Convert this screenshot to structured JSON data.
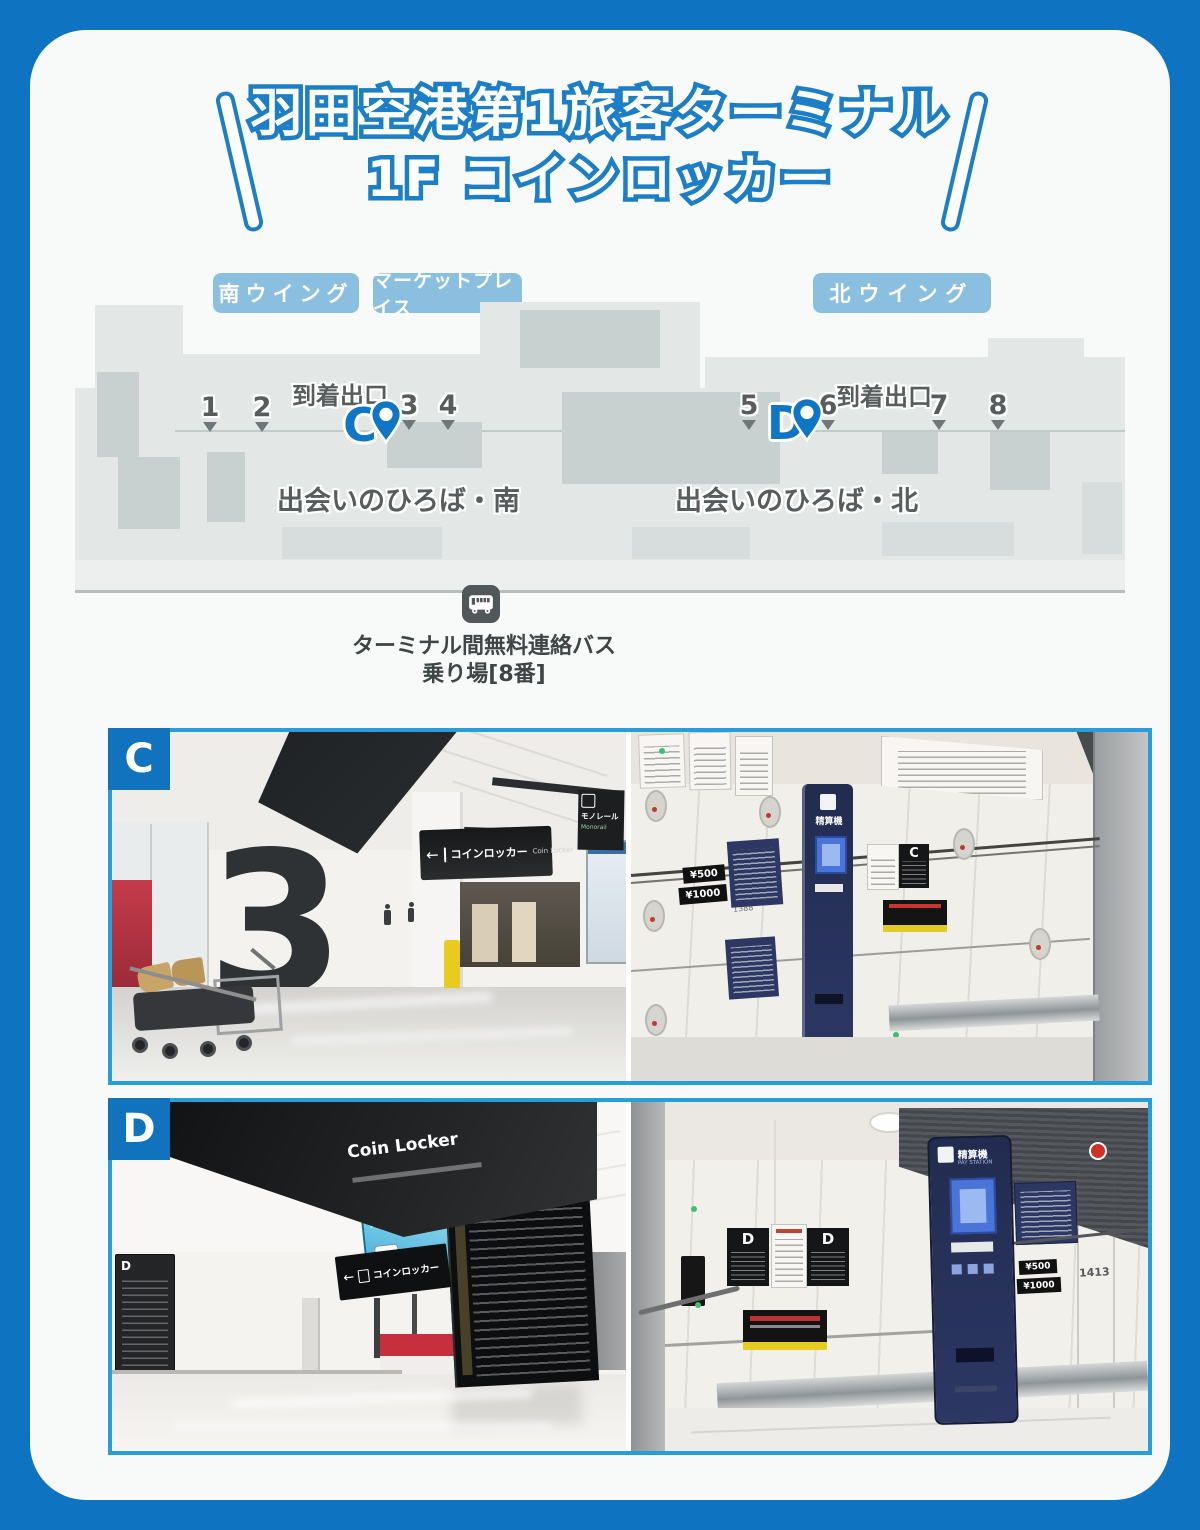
{
  "colors": {
    "background_blue": "#0e74c2",
    "frame_blue": "#259ed9",
    "badge_blue": "#8bbfdf",
    "pin_blue": "#0f76c6",
    "section_label_blue": "#1173bd",
    "title_outline_blue": "#1b7ec7"
  },
  "glyphs": {
    "arrow_left": "←"
  },
  "title": {
    "line1": "羽田空港第1旅客ターミナル",
    "line2": "1F コインロッカー"
  },
  "wings": [
    {
      "label": "南ウイング"
    },
    {
      "label": "マーケットプレイス"
    },
    {
      "label": "北ウイング"
    }
  ],
  "map": {
    "arrival_left": "到着出口",
    "arrival_right": "到着出口",
    "exit_numbers": [
      "1",
      "2",
      "3",
      "4",
      "5",
      "6",
      "7",
      "8"
    ],
    "pin_c": "C",
    "pin_d": "D",
    "plaza_south": "出会いのひろば・南",
    "plaza_north": "出会いのひろば・北"
  },
  "bus": {
    "line1": "ターミナル間無料連絡バス",
    "line2": "乗り場[8番]"
  },
  "section_c": {
    "label": "C",
    "corridor": {
      "gate_number": "3",
      "locker_sign_jp": "コインロッカー",
      "locker_sign_en": "Coin Locker",
      "monorail_sign_jp": "モノレール",
      "monorail_sign_en": "Monorail"
    },
    "lockers": {
      "machine_label": "精算機",
      "price_small": "¥500",
      "price_large": "¥1000",
      "locker_number": "1388",
      "area_sign": "C"
    }
  },
  "section_d": {
    "label": "D",
    "corridor": {
      "ceiling_sign_en": "Coin Locker",
      "hanging_sign_jp": "コインロッカー",
      "ad_headline": "全国20万件の荷物預かり",
      "info_board_label": "D"
    },
    "lockers": {
      "machine_label": "精算機",
      "machine_label_en": "PAY STATION",
      "price_small": "¥500",
      "price_large": "¥1000",
      "locker_number": "1413",
      "area_sign_left": "D",
      "area_sign_right": "D"
    }
  }
}
